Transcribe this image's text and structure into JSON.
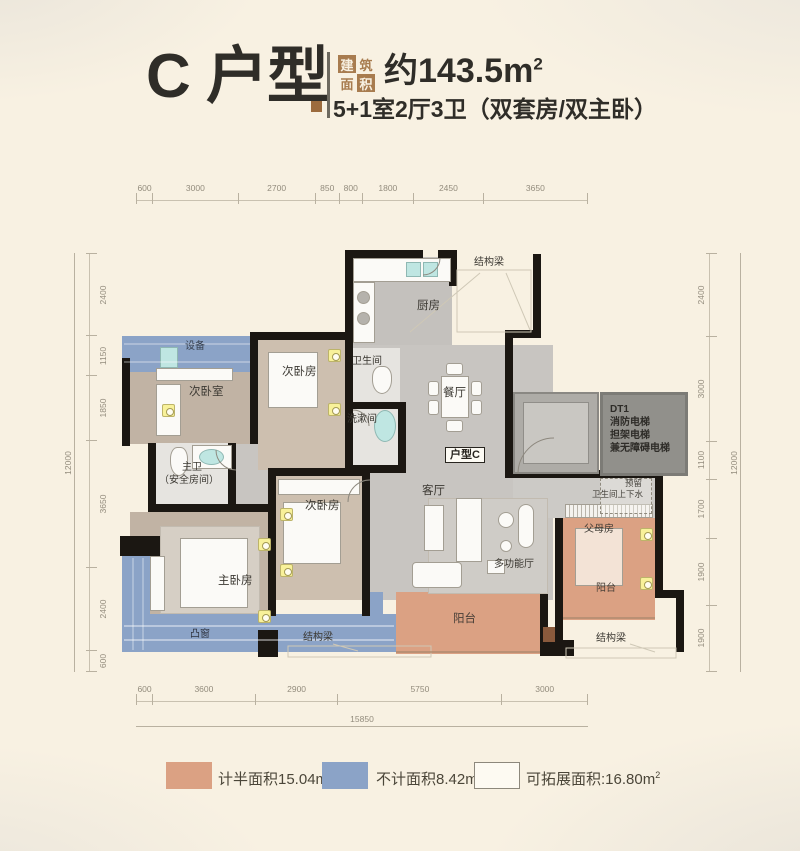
{
  "header": {
    "unit_name": "C 户型",
    "badge_chars": [
      "建",
      "筑",
      "面",
      "积"
    ],
    "area_value": "约143.5m",
    "area_sup": "2",
    "subtitle": "5+1室2厅3卫（双套房/双主卧）"
  },
  "plan": {
    "labels": {
      "kitchen": "厨房",
      "equipment": "设备",
      "bedroom_left": "次卧室",
      "bedroom_top": "次卧房",
      "bathroom": "卫生间",
      "washroom": "洗漱间",
      "dining": "餐厅",
      "unit_tag": "户型C",
      "master_bath": "主卫",
      "master_bath_sub": "（安全房间）",
      "bedroom_mid": "次卧房",
      "living": "客厅",
      "multi_hall": "多功能厅",
      "master_bedroom": "主卧房",
      "bay_window": "凸窗",
      "balcony_main": "阳台",
      "parents_room": "父母房",
      "balcony_right": "阳台",
      "reserved_line1": "预留",
      "reserved_line2": "卫生间上下水",
      "beam_top": "结构梁",
      "beam_bottom_left": "结构梁",
      "beam_bottom_right": "结构梁"
    },
    "elevator": {
      "line1": "DT1",
      "line2": "消防电梯",
      "line3": "担架电梯",
      "line4": "兼无障碍电梯"
    }
  },
  "dimensions": {
    "top": [
      "600",
      "3000",
      "2700",
      "850",
      "800",
      "1800",
      "2450",
      "3650"
    ],
    "bottom": [
      "600",
      "3600",
      "2900",
      "5750",
      "3000"
    ],
    "bottom_total": "15850",
    "left": [
      "2400",
      "1150",
      "1850",
      "3650",
      "2400",
      "600"
    ],
    "left_total": "12000",
    "right": [
      "2400",
      "3000",
      "1100",
      "1700",
      "1900",
      "1900"
    ],
    "right_total": "12000"
  },
  "legend": {
    "items": [
      {
        "label": "计半面积15.04m",
        "sup": "2",
        "color": "#dba183"
      },
      {
        "label": "不计面积8.42m",
        "sup": "2",
        "color": "#8ba3c7"
      },
      {
        "label": "可拓展面积:16.80m",
        "sup": "2",
        "color": "#fdfaf2"
      }
    ]
  },
  "colors": {
    "background": "#f8f1e2",
    "title_text": "#2f2d28",
    "accent_brown": "#a87c4f",
    "wall_black": "#1b1712",
    "floor_gray": "#c8c5c1",
    "floor_wood": "#c5b7a8",
    "tile": "#e6e4e0",
    "half_area_orange": "#dba183",
    "excluded_blue": "#8ba3c7",
    "expandable_white": "#fdfaf2"
  }
}
